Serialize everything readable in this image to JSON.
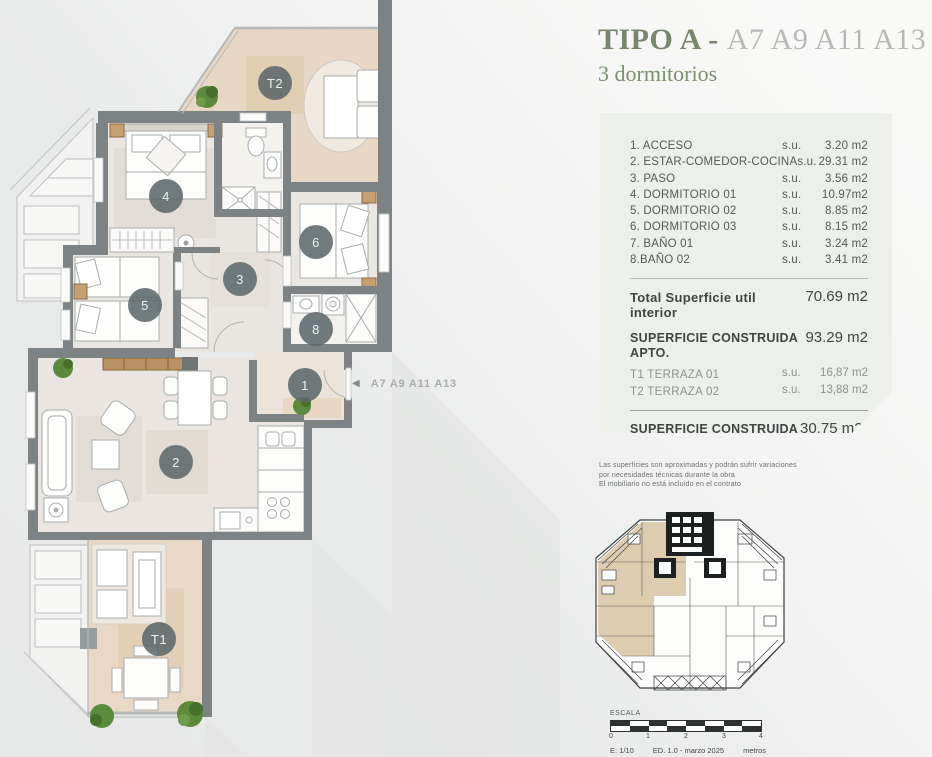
{
  "header": {
    "title_main": "TIPO A -",
    "title_units": "A7 A9 A11 A13",
    "subtitle": "3 dormitorios"
  },
  "card": {
    "rooms": [
      {
        "label": "1. ACCESO",
        "su": "s.u.",
        "value": "3.20 m2"
      },
      {
        "label": "2. ESTAR-COMEDOR-COCINA",
        "su": "s.u.",
        "value": "29.31 m2"
      },
      {
        "label": "3. PASO",
        "su": "s.u.",
        "value": "3.56 m2"
      },
      {
        "label": "4. DORMITORIO 01",
        "su": "s.u.",
        "value": "10.97m2"
      },
      {
        "label": "5. DORMITORIO 02",
        "su": "s.u.",
        "value": "8.85 m2"
      },
      {
        "label": "6. DORMITORIO 03",
        "su": "s.u.",
        "value": "8.15 m2"
      },
      {
        "label": "7. BAÑO 01",
        "su": "s.u.",
        "value": "3.24 m2"
      },
      {
        "label": "8.BAÑO 02",
        "su": "s.u.",
        "value": "3.41 m2"
      }
    ],
    "total_util": {
      "label": "Total Superficie util interior",
      "value": "70.69 m2"
    },
    "construida_apto": {
      "label": "SUPERFICIE CONSTRUIDA APTO.",
      "value": "93.29 m2"
    },
    "terrazas": [
      {
        "label": "T1 TERRAZA 01",
        "su": "s.u.",
        "value": "16,87 m2"
      },
      {
        "label": "T2 TERRAZA 02",
        "su": "s.u.",
        "value": "13,88 m2"
      }
    ],
    "construida_terrazas": {
      "label": "SUPERFICIE CONSTRUIDA TERRAZAS",
      "value": "30,75 m2"
    },
    "total_apartamento": {
      "label": "SUPERFICIE TOTAL APARTAMENTO",
      "value": "124,04 m2"
    }
  },
  "disclaimer": {
    "line1": "Las superficies son aproximadas y podrán sufrir variaciones",
    "line2": "por necesidades técnicas durante la obra",
    "line3": "El mobiliario no está incluido en el contrato"
  },
  "scalebar": {
    "title": "ESCALA",
    "ticks": [
      "0",
      "1",
      "2",
      "3",
      "4"
    ],
    "scale": "E: 1/10",
    "edition": "ED. 1.0 - marzo 2025",
    "units": "metros"
  },
  "plan": {
    "markers": [
      {
        "label": "T2"
      },
      {
        "label": "4"
      },
      {
        "label": "6"
      },
      {
        "label": "3"
      },
      {
        "label": "5"
      },
      {
        "label": "8"
      },
      {
        "label": "1"
      },
      {
        "label": "2"
      },
      {
        "label": "T1"
      }
    ],
    "arrow_label": "A7 A9 A11 A13"
  },
  "colors": {
    "wall": "#7d8384",
    "terrace_floor": "#e8d7c4",
    "interior_floor": "#eae6e1",
    "marker": "#5d686b",
    "title_green": "#77866c",
    "total_accent": "#c89a6a"
  }
}
